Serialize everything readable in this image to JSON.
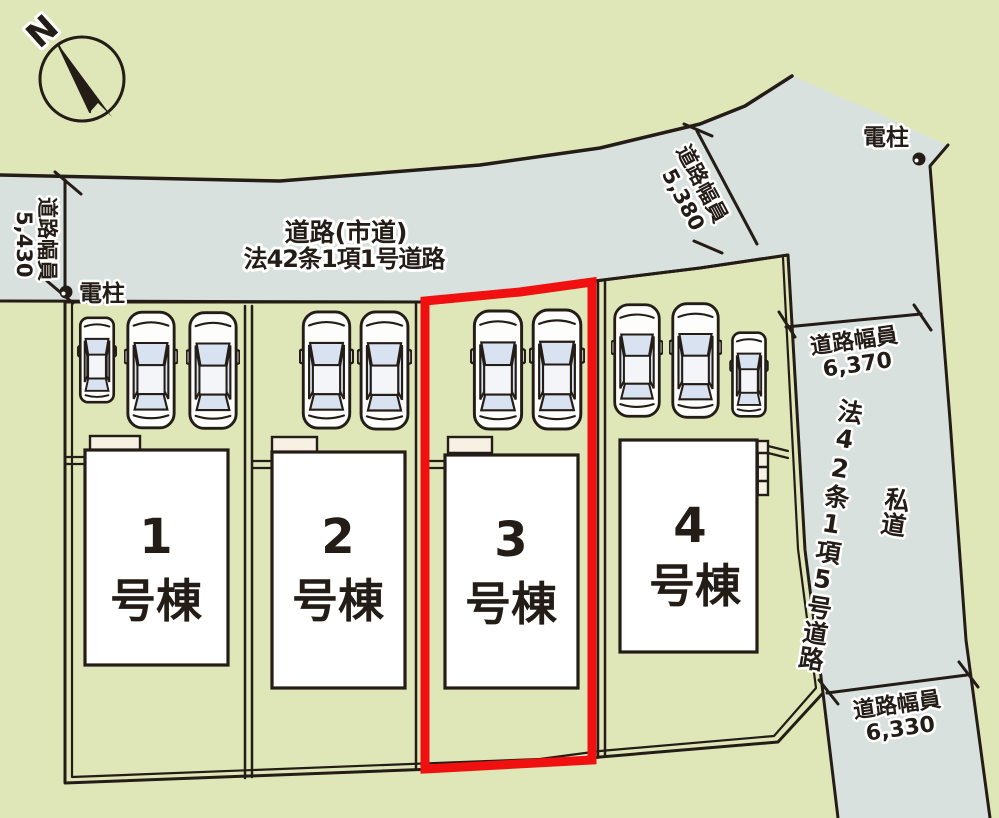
{
  "plan": {
    "compass": {
      "north_label": "N"
    },
    "main_road": {
      "line1": "道路(市道)",
      "line2": "法42条1項1号道路"
    },
    "private_road": {
      "type": "私道",
      "name": "法42条1項5号道路"
    },
    "measurements": {
      "west": {
        "label": "道路幅員",
        "value": "5,430"
      },
      "north": {
        "label": "道路幅員",
        "value": "5,380"
      },
      "east_upper": {
        "label": "道路幅員",
        "value": "6,370"
      },
      "east_lower": {
        "label": "道路幅員",
        "value": "6,330"
      }
    },
    "utility_pole_west": {
      "label": "電柱"
    },
    "utility_pole_east": {
      "label": "電柱"
    },
    "lots": [
      {
        "number": "1",
        "suffix": "号棟",
        "highlighted": false,
        "cars": 3
      },
      {
        "number": "2",
        "suffix": "号棟",
        "highlighted": false,
        "cars": 2
      },
      {
        "number": "3",
        "suffix": "号棟",
        "highlighted": true,
        "cars": 2
      },
      {
        "number": "4",
        "suffix": "号棟",
        "highlighted": false,
        "cars": 3
      }
    ],
    "colors": {
      "background": "#dfe7b8",
      "road": "#d9e1de",
      "lot_area": "#f6f1e2",
      "house_fill": "#ffffff",
      "line": "#241c16",
      "highlight_red": "#f01010"
    }
  }
}
